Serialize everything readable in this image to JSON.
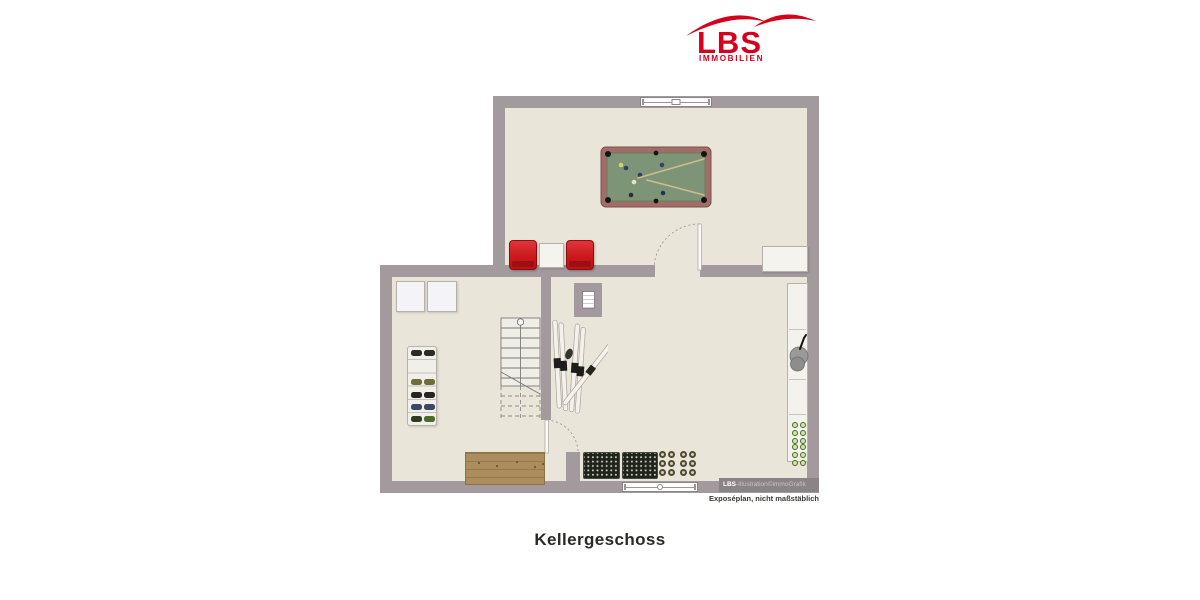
{
  "page": {
    "title": "Kellergeschoss"
  },
  "logo": {
    "brand": "LBS",
    "division": "IMMOBILIEN",
    "color": "#d6001c"
  },
  "credits": {
    "brand": "LBS",
    "illustration": "-Illustration©immoGrafik",
    "disclaimer": "Exposéplan, nicht maßstäblich"
  },
  "colors": {
    "wall": "#a29a9c",
    "floor": "#eae5d9",
    "logo_red": "#d6001c",
    "chair_red": "#c8181b",
    "pool_rail": "#a06d68",
    "pool_felt": "#7e9476",
    "bench_wood": "#ac8e5d"
  }
}
